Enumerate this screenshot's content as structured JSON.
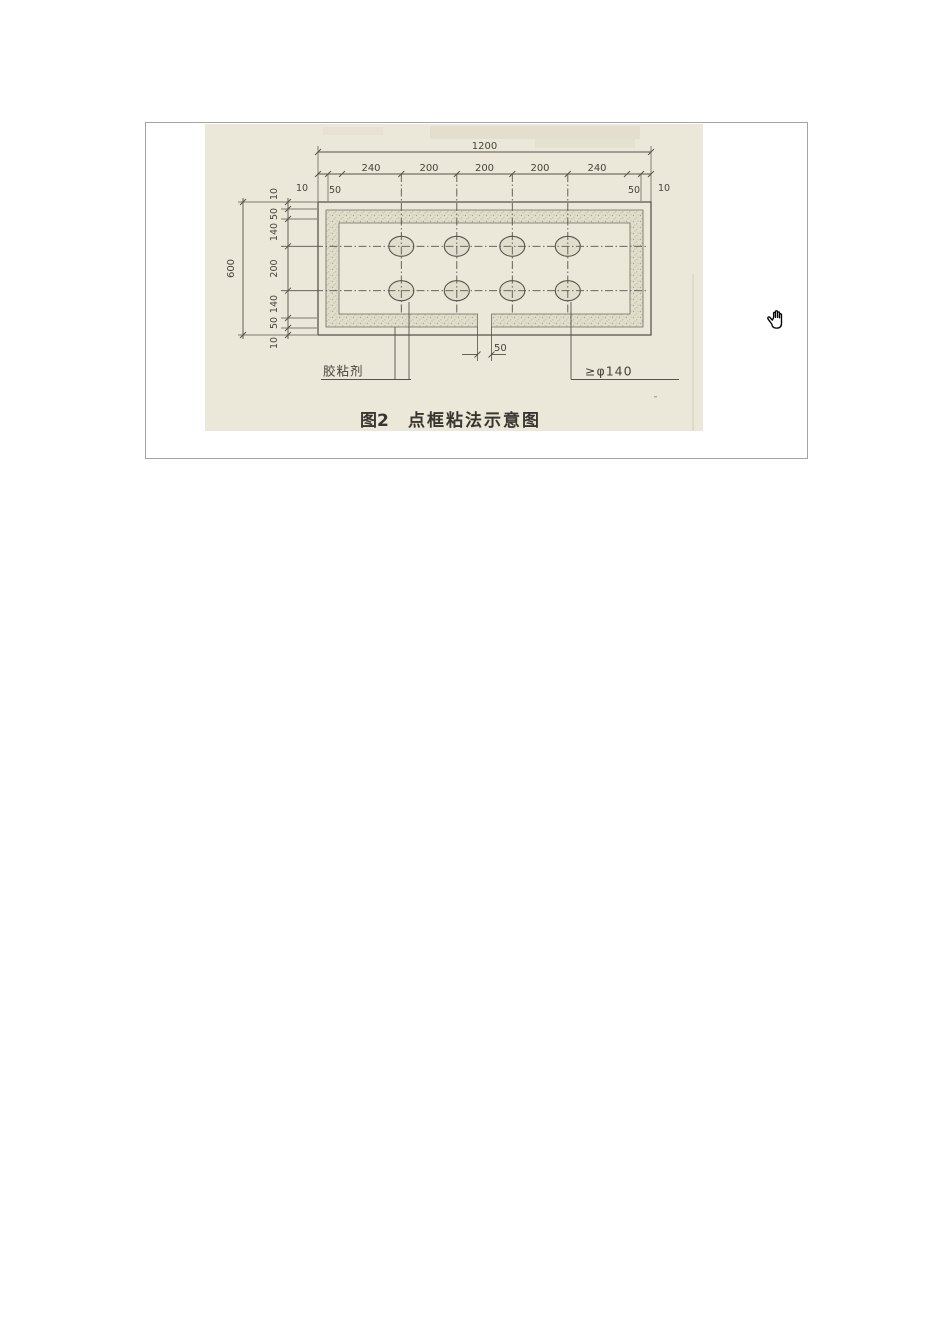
{
  "figure": {
    "caption": {
      "label": "图2",
      "title": "点框粘法示意图"
    },
    "labels": {
      "adhesive": "胶粘剂",
      "dot_diameter": "≥φ140"
    },
    "dimensions": {
      "total_width": "1200",
      "top_segments": [
        "240",
        "200",
        "200",
        "200",
        "240"
      ],
      "top_left_edge": "10",
      "top_left_inset": "50",
      "top_right_inset": "50",
      "top_right_edge": "10",
      "total_height": "600",
      "left_segments": [
        "10",
        "50",
        "140",
        "200",
        "140",
        "50",
        "10"
      ],
      "bottom_gap": "50"
    },
    "adhesive_dots": {
      "rows": 2,
      "columns": 4
    },
    "colors": {
      "scan_background": "#ece8d9",
      "line": "#54524a",
      "text": "#45443c"
    }
  },
  "cursor": {
    "icon": "hand-grab"
  }
}
